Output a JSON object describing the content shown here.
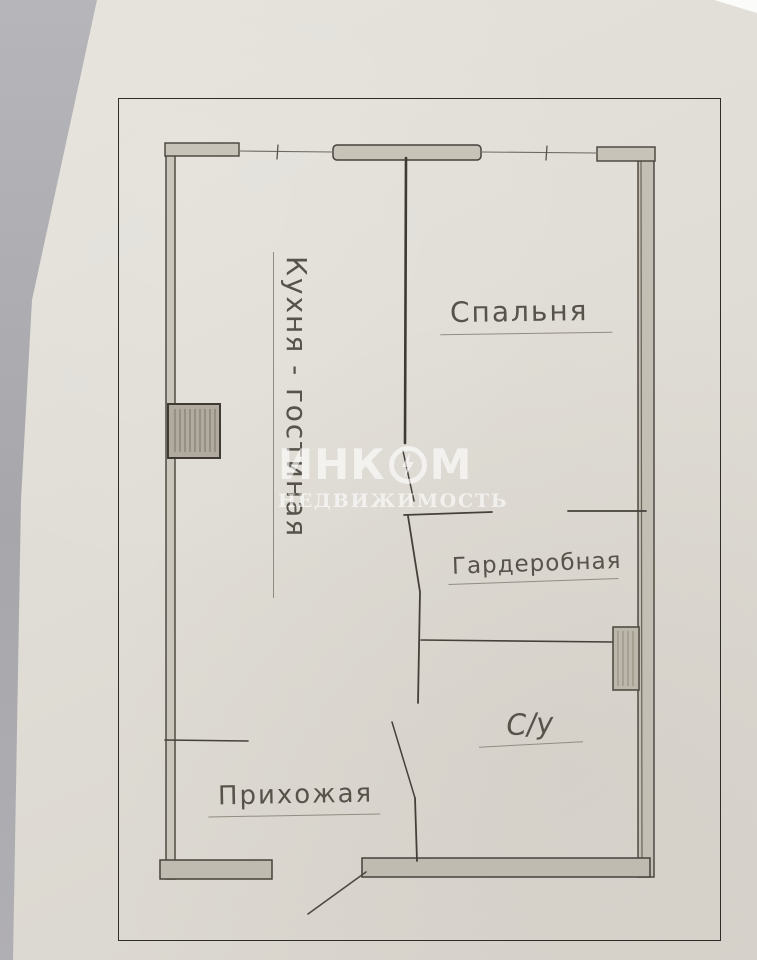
{
  "colors": {
    "paper": "#e0ddd6",
    "background_gray": "#a8a8ac",
    "pencil": "#4a453d",
    "frame_line": "#2f2d29",
    "watermark_white": "rgba(255,255,255,0.62)"
  },
  "watermark": {
    "brand_prefix": "ИНК",
    "brand_suffix": "М",
    "tagline": "НЕДВИЖИМОСТЬ"
  },
  "rooms": {
    "kitchen_living": {
      "label": "Кухня - гостиная"
    },
    "bedroom": {
      "label": "Спальня"
    },
    "wardrobe": {
      "label": "Гардеробная"
    },
    "bathroom": {
      "label": "С/у"
    },
    "hallway": {
      "label": "Прихожая"
    }
  }
}
